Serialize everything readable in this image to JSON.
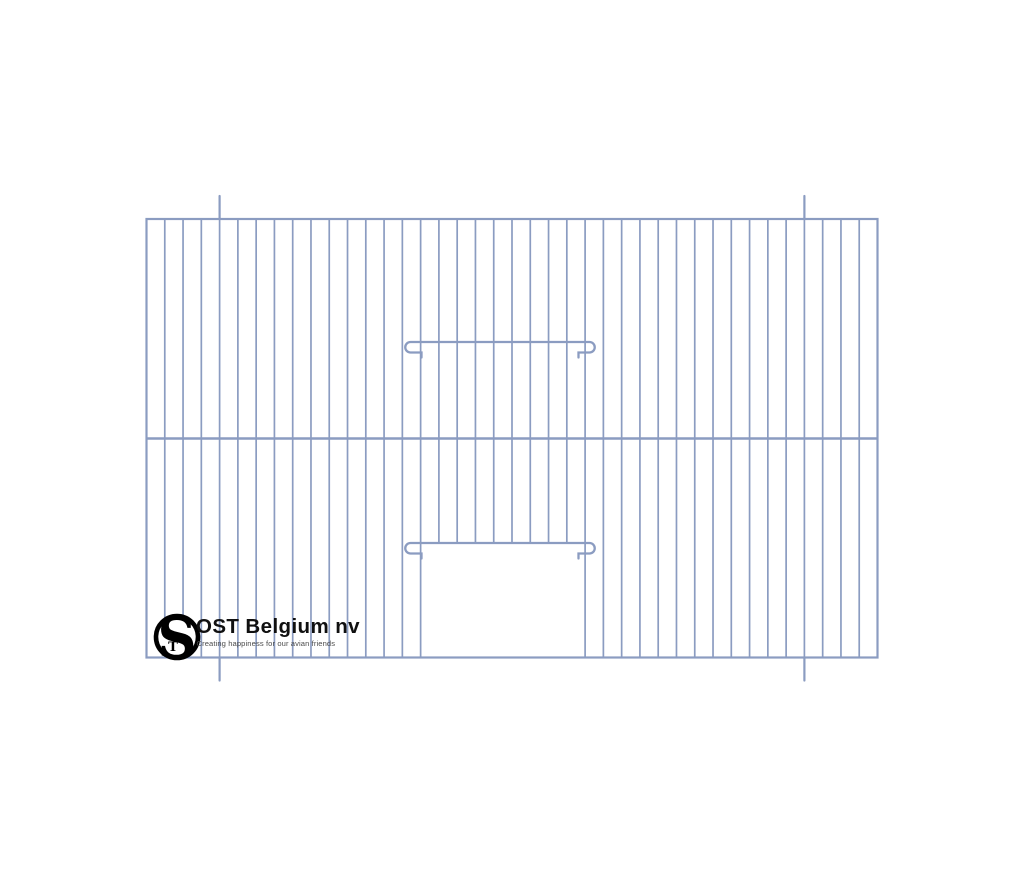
{
  "page": {
    "background_color": "#ffffff"
  },
  "drawing": {
    "description": "cage front wire panel technical drawing",
    "stroke": {
      "color": "#8b9cc1",
      "wire_width": 1.7,
      "frame_width": 2.2,
      "bar_width": 2.6,
      "hook_width": 2.3,
      "pin_width": 2.2
    },
    "frame": {
      "left": 146.5,
      "top": 219,
      "right": 877.5,
      "bottom": 657.5
    },
    "vertical_wires": {
      "gaps": 40
    },
    "middle_bar_y": 438.5,
    "door": {
      "left_wire": 15,
      "right_wire": 24,
      "sill_y": 543
    },
    "hook_bars": {
      "ys": [
        342,
        543
      ],
      "x1": 410.5,
      "x2": 589.5,
      "loop_radius": 5.25,
      "return_inset": 11,
      "tick_length": 5
    },
    "pins": {
      "wire_indices": [
        4,
        36
      ],
      "overhang": 23
    }
  },
  "logo": {
    "monogram_s": "S",
    "monogram_t": "T",
    "ring_color": "#000000",
    "company": "OST Belgium nv",
    "tagline": "Creating happiness for our avian friends",
    "company_color": "#101010",
    "tagline_color": "#4d4d4d"
  }
}
